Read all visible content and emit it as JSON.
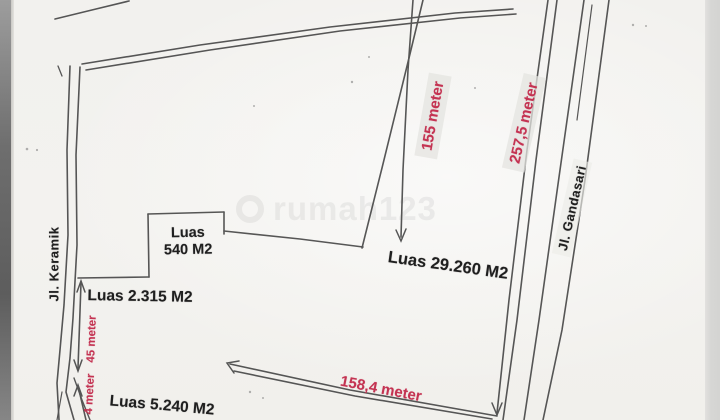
{
  "streets": {
    "keramik": "Jl. Keramik",
    "gandasari": "Jl. Gandasari"
  },
  "areas": {
    "plot_540": {
      "line1": "Luas",
      "line2": "540 M2"
    },
    "plot_2315": "Luas 2.315 M2",
    "plot_29260": "Luas 29.260 M2",
    "plot_5240": "Luas 5.240 M2"
  },
  "measurements": {
    "depth_155": "155 meter",
    "east_frontage_2575": "257,5 meter",
    "south_width_1584": "158,4 meter",
    "west_45": "45 meter",
    "west_partial_4": "4 meter"
  },
  "watermark": "rumah123",
  "colors": {
    "measurement_red": "#c43352",
    "ink": "#3f3f3f",
    "paper": "#f3f2ef"
  }
}
